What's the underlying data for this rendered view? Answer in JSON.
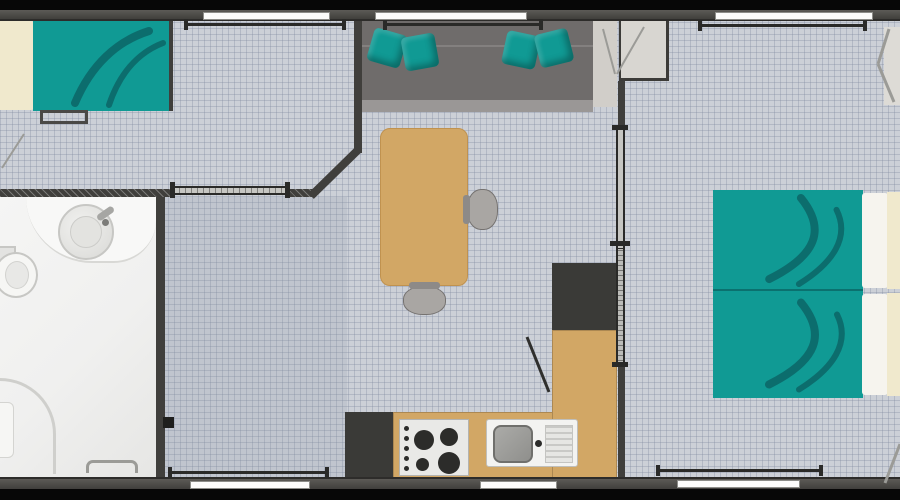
{
  "palette": {
    "frame": "#070707",
    "wall": "#403f3c",
    "wall_light": "#5c5a56",
    "window": "#fcfcfb",
    "floor": "#ccd0d7",
    "floor_line": "rgba(126,138,158,0.33)",
    "corridor_tint": "rgba(138,148,166,0.18)",
    "teal": "#109a94",
    "teal_dark": "#0b6163",
    "cream": "#f0e9cd",
    "sheet": "#f6f4ee",
    "wood": "#d2a765",
    "wood_edge": "#c0924f",
    "sofa": "#6f6c6b",
    "sofa_edge": "#9a9796",
    "dark_appliance": "#3a3a37",
    "chair": "#a9a6a3",
    "bath": "#f0f0ef",
    "fixture": "#c7c7c4",
    "rail": "#2a2a28",
    "line_gray": "#9b9b97"
  },
  "scene": {
    "type": "mobile-home-floor-plan",
    "rooms": [
      {
        "name": "bedroom-left",
        "furniture": [
          "double-bed",
          "pillow",
          "bench",
          "sliding-door",
          "window",
          "curtain-rail"
        ]
      },
      {
        "name": "living-room",
        "furniture": [
          "sofa",
          "cushion",
          "cushion",
          "cushion",
          "cushion",
          "dining-table",
          "chair",
          "chair",
          "window",
          "curtain-rail"
        ]
      },
      {
        "name": "kitchen",
        "furniture": [
          "fridge",
          "cooktop",
          "sink",
          "l-shaped-counter",
          "tall-appliance",
          "window"
        ]
      },
      {
        "name": "bathroom",
        "furniture": [
          "washbasin",
          "toilet",
          "shower",
          "door"
        ]
      },
      {
        "name": "bedroom-right",
        "furniture": [
          "single-bed",
          "single-bed",
          "wardrobe",
          "sliding-door",
          "window",
          "window",
          "curtain-rail"
        ]
      }
    ]
  }
}
